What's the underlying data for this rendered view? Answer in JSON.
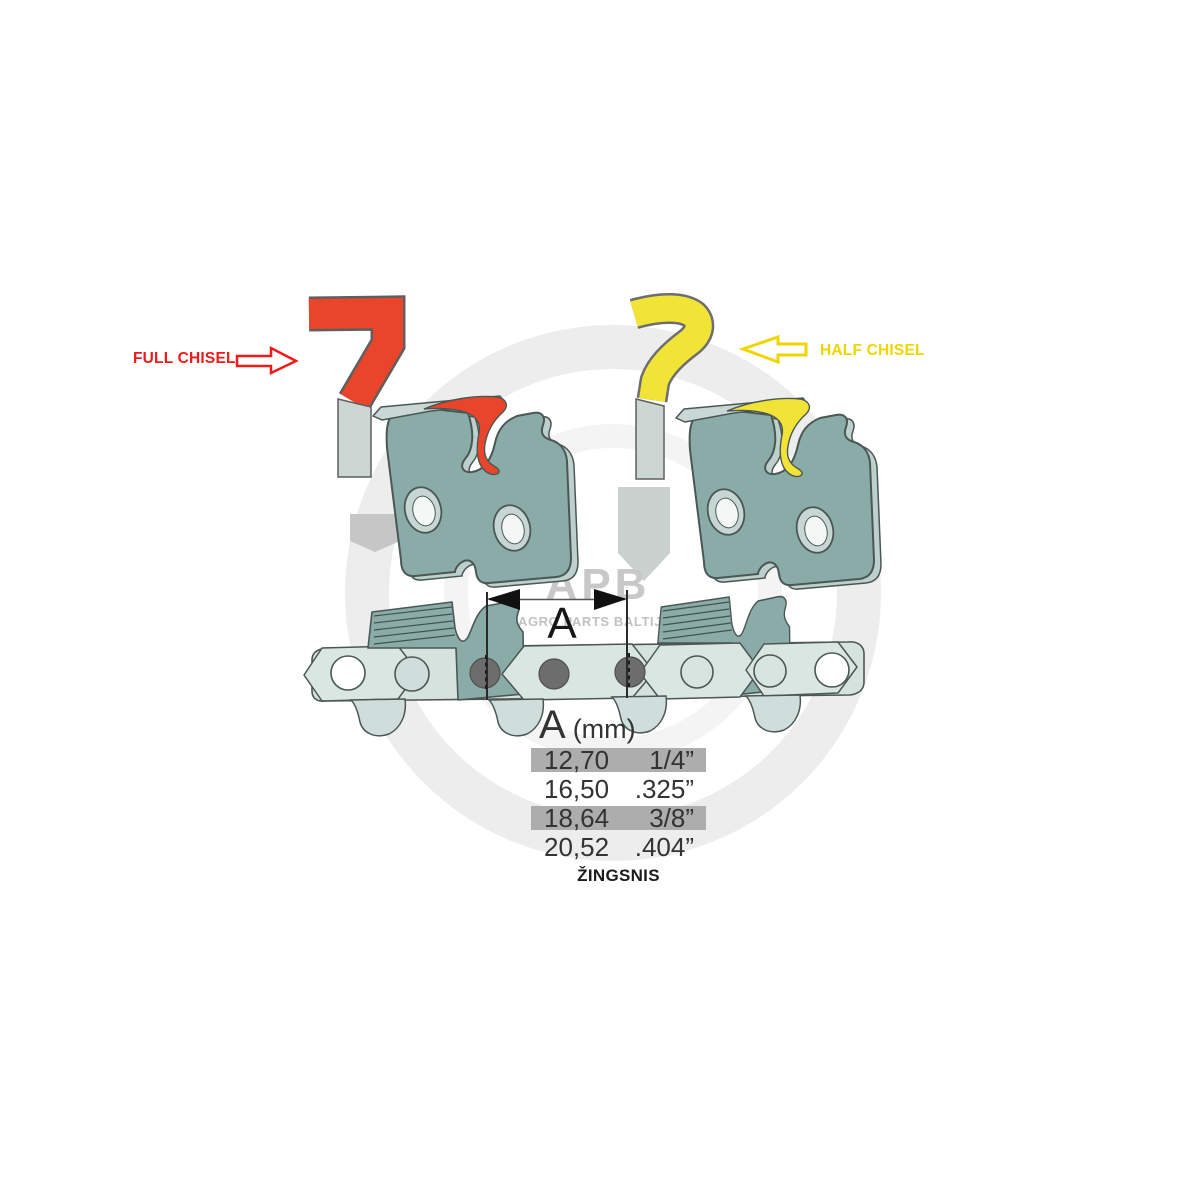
{
  "labels": {
    "full_chisel": "FULL CHISEL",
    "half_chisel": "HALF CHISEL",
    "dimension_letter": "A",
    "pitch_caption": "ŽINGSNIS"
  },
  "pitch_table": {
    "header_symbol": "A",
    "header_unit": "(mm)",
    "rows": [
      {
        "mm": "12,70",
        "inches": "1/4”",
        "highlighted": true
      },
      {
        "mm": "16,50",
        "inches": ".325”",
        "highlighted": false
      },
      {
        "mm": "18,64",
        "inches": "3/8”",
        "highlighted": true
      },
      {
        "mm": "20,52",
        "inches": ".404”",
        "highlighted": false
      }
    ]
  },
  "watermark": {
    "brand": "APB",
    "subtitle": "AGRO PARTS BALTIJA"
  },
  "colors": {
    "full_chisel_red": "#e8452a",
    "half_chisel_yellow": "#f2e437",
    "label_red": "#ee1b1b",
    "label_yellow": "#f0d600",
    "link_teal": "#8aaca8",
    "chain_light": "#d6e2de",
    "rivet_gray": "#6d6d6d",
    "table_band_gray": "#adadad",
    "table_text": "#333333",
    "watermark_gray": "#ededed"
  }
}
